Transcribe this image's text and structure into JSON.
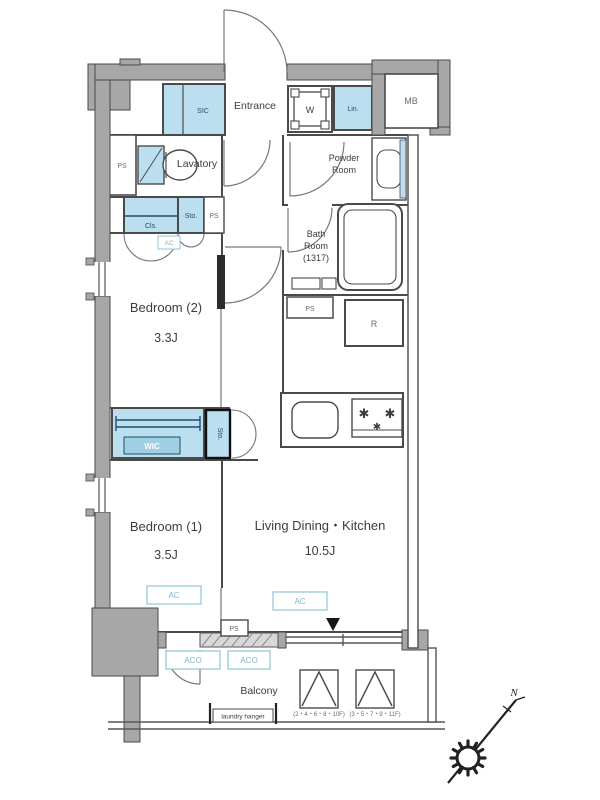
{
  "floorplan": {
    "rooms": {
      "entrance": "Entrance",
      "lavatory": "Lavatory",
      "powder_line1": "Powder",
      "powder_line2": "Room",
      "bath_line1": "Bath",
      "bath_line2": "Room",
      "bath_size": "(1317)",
      "bedroom2": "Bedroom (2)",
      "bedroom2_size": "3.3J",
      "bedroom1": "Bedroom (1)",
      "bedroom1_size": "3.5J",
      "ldk": "Living Dining・Kitchen",
      "ldk_size": "10.5J"
    },
    "small_labels": {
      "ps": "PS",
      "ac": "AC",
      "aco": "ACO",
      "w": "W",
      "lin": "Lin.",
      "mb": "MB",
      "r": "R",
      "cls": "Cls.",
      "sto": "Sto.",
      "sic": "SIC",
      "wic": "WIC"
    },
    "balcony": {
      "label": "Balcony",
      "laundry_hanger": "laundry hanger",
      "outdoor_unit_note_left": "(2・4・6・8・10F)",
      "outdoor_unit_note_right": "(3・5・7・9・11F)"
    },
    "compass": {
      "north": "N"
    },
    "colors": {
      "wall_gray": "#a7a7a7",
      "fixture_blue": "#bcdff0",
      "accent_teal": "#8fc6d4",
      "label_navy": "#1f4e6e",
      "line": "#4a4a4a"
    }
  }
}
